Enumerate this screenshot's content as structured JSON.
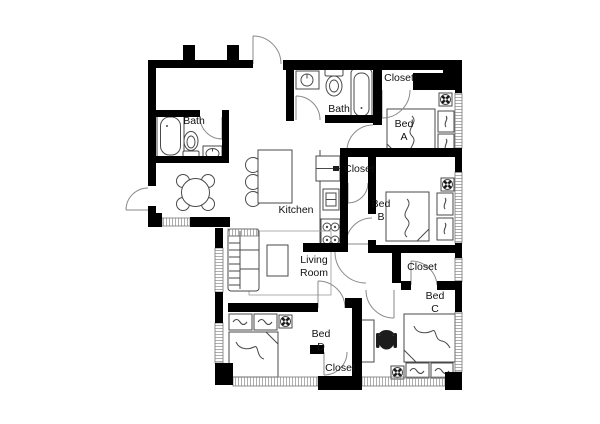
{
  "title": "Apartment floor plan",
  "colors": {
    "background": "#ffffff",
    "walls": "#000000",
    "furniture_line": "#4a4a4a",
    "door_arc": "#8a8a8a",
    "label_text": "#111111"
  },
  "rooms": {
    "bath_left": {
      "label": "Bath"
    },
    "bath_top": {
      "label": "Bath"
    },
    "closet_top_right": {
      "label": "Closet"
    },
    "closet_hall": {
      "label": "Closet"
    },
    "closet_bed_c": {
      "label": "Closet"
    },
    "closet_bed_d": {
      "label": "Closet"
    },
    "bed_a": {
      "line1": "Bed",
      "line2": "A"
    },
    "bed_b": {
      "line1": "Bed",
      "line2": "B"
    },
    "bed_c": {
      "line1": "Bed",
      "line2": "C"
    },
    "bed_d": {
      "line1": "Bed",
      "line2": "D"
    },
    "kitchen": {
      "label": "Kitchen"
    },
    "living_room": {
      "line1": "Living",
      "line2": "Room"
    }
  },
  "fixtures": [
    "bathtub",
    "toilet",
    "sink",
    "dining-table",
    "kitchen-island",
    "bar-stool",
    "refrigerator",
    "kitchen-sink",
    "stove",
    "sofa",
    "rug",
    "coffee-table",
    "bed",
    "nightstand-lamp",
    "dresser",
    "ceiling-fan",
    "desk",
    "office-chair",
    "door-swing",
    "window"
  ]
}
